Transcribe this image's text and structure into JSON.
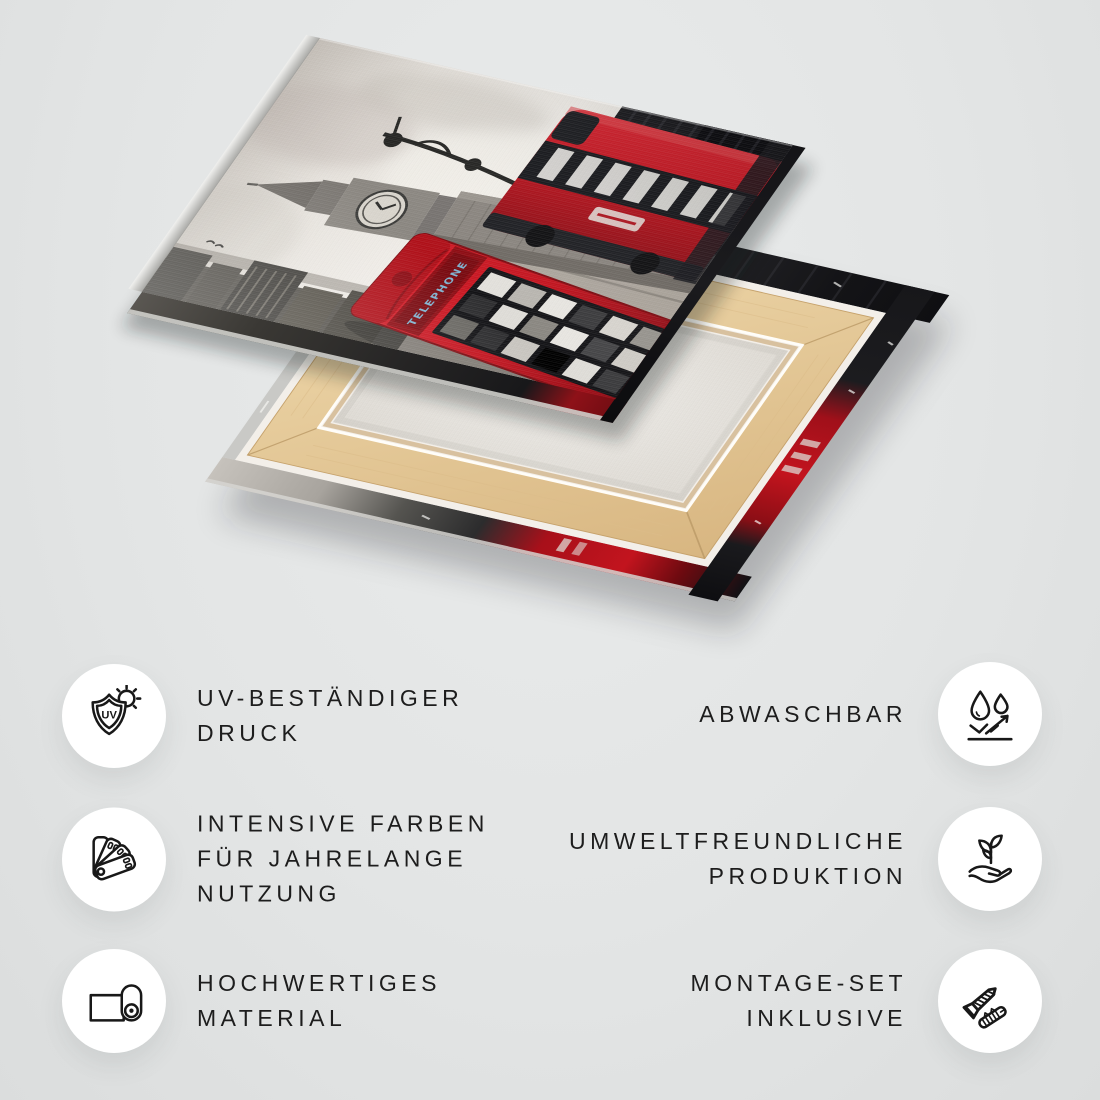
{
  "page": {
    "background": "#e3e5e5",
    "text_color": "#1d1d1d",
    "circle_color": "#ffffff"
  },
  "mockup": {
    "description": "canvas print shown from front (London scene: Big Ben, red double-decker bus, red telephone box, black and white with red accents) and from back (wooden stretcher frame with white canvas)",
    "telephone_sign": "TELEPHONE",
    "accent_red": "#c0121d",
    "wood_color": "#e7cda0",
    "canvas_back_color": "#e9e7e3",
    "silver_edge_color": "#c9c9c6"
  },
  "features": [
    {
      "icon": "uv-shield-sun-icon",
      "label_lines": [
        "UV-BESTÄNDIGER",
        "DRUCK"
      ]
    },
    {
      "icon": "water-drops-surface-icon",
      "label_lines": [
        "ABWASCHBAR"
      ]
    },
    {
      "icon": "color-swatch-fan-icon",
      "label_lines": [
        "INTENSIVE FARBEN",
        "FÜR JAHRELANGE",
        "NUTZUNG"
      ]
    },
    {
      "icon": "hand-plant-icon",
      "label_lines": [
        "UMWELTFREUNDLICHE",
        "PRODUKTION"
      ]
    },
    {
      "icon": "canvas-roll-icon",
      "label_lines": [
        "HOCHWERTIGES",
        "MATERIAL"
      ]
    },
    {
      "icon": "screw-dowel-icon",
      "label_lines": [
        "MONTAGE-SET",
        "INKLUSIVE"
      ]
    },
    {
      "uv_shield_text": "UV"
    }
  ]
}
